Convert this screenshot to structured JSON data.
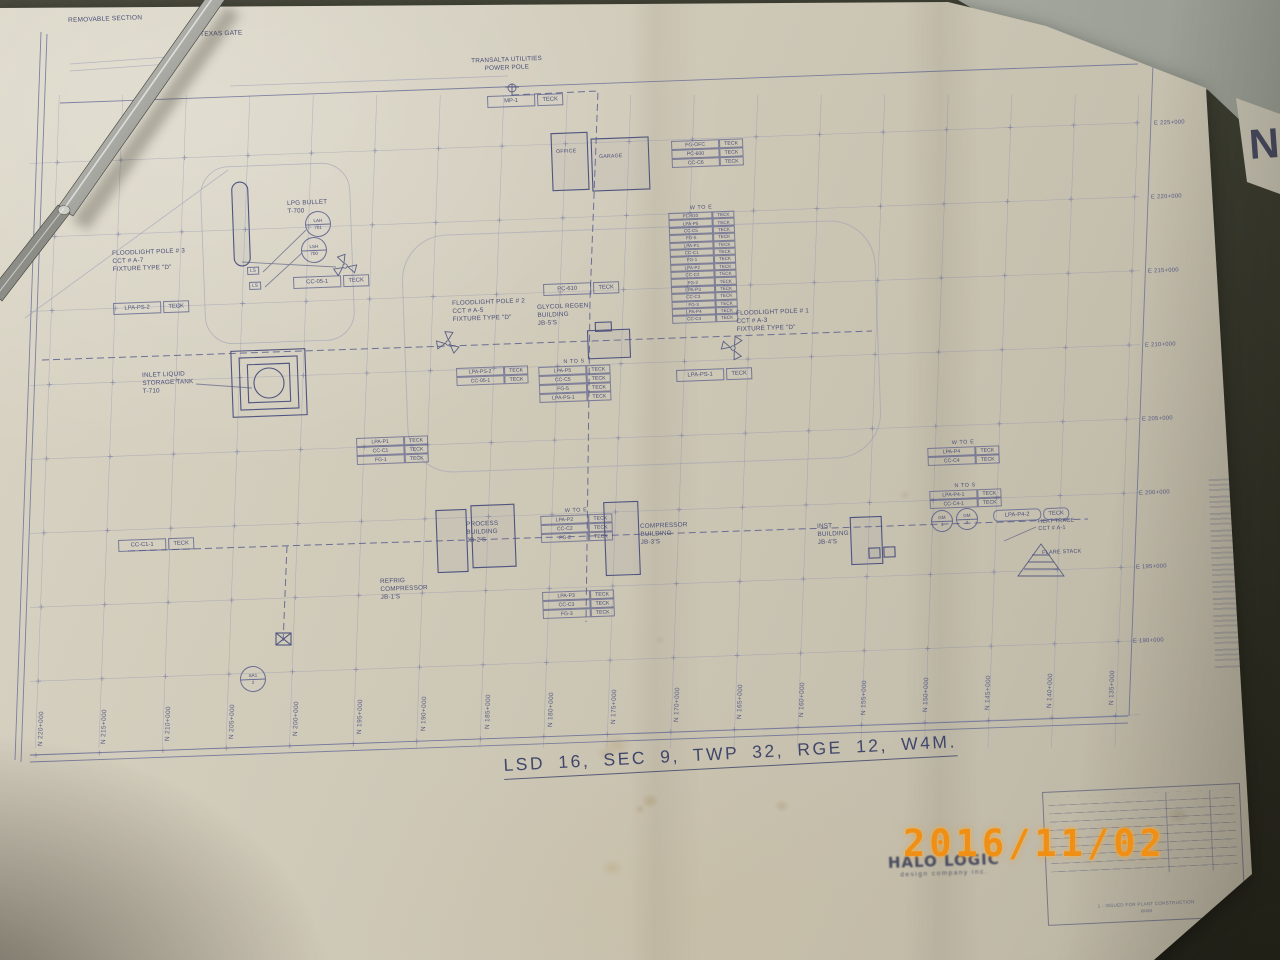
{
  "camera": {
    "timestamp": "2016/11/02"
  },
  "drawing": {
    "legal_description": "LSD 16, SEC 9, TWP 32, RGE 12, W4M.",
    "corner_letter": "N",
    "cable_type": "TECK",
    "logo": {
      "name": "HALO LOGIC",
      "tagline": "design company inc."
    },
    "title_block": {
      "revision_note_1": "1 - ISSUED FOR PLANT CONSTRUCTION",
      "revision_note_2": "W4M"
    },
    "labels": [
      {
        "x": 68,
        "y": 17,
        "size": 6.5,
        "lines": [
          "REMOVABLE SECTION"
        ]
      },
      {
        "x": 200,
        "y": 31,
        "size": 6.5,
        "lines": [
          "TEXAS GATE"
        ]
      },
      {
        "x": 459,
        "y": 58,
        "center": true,
        "w": 95,
        "lines": [
          "TRANSALTA UTILITIES",
          "POWER POLE"
        ]
      },
      {
        "x": 287,
        "y": 200,
        "lines": [
          "LPG BULLET",
          "T-700"
        ]
      },
      {
        "x": 112,
        "y": 250,
        "lines": [
          "FLOODLIGHT POLE # 3",
          "CCT # A-7",
          "FIXTURE TYPE \"D\""
        ]
      },
      {
        "x": 452,
        "y": 300,
        "lines": [
          "FLOODLIGHT POLE # 2",
          "CCT # A-5",
          "FIXTURE TYPE \"D\""
        ]
      },
      {
        "x": 537,
        "y": 304,
        "lines": [
          "GLYCOL REGEN",
          "BUILDING",
          "JB-5'S"
        ]
      },
      {
        "x": 736,
        "y": 310,
        "lines": [
          "FLOODLIGHT POLE # 1",
          "CCT # A-3",
          "FIXTURE TYPE \"D\""
        ]
      },
      {
        "x": 142,
        "y": 372,
        "lines": [
          "INLET LIQUID",
          "STORAGE TANK",
          "T-710"
        ]
      },
      {
        "x": 466,
        "y": 521,
        "lines": [
          "PROCESS",
          "BUILDING",
          "JB-2'S"
        ]
      },
      {
        "x": 640,
        "y": 523,
        "lines": [
          "COMPRESSOR",
          "BUILDING",
          "JB-3'S"
        ]
      },
      {
        "x": 817,
        "y": 523,
        "lines": [
          "INST",
          "BUILDING",
          "JB-4'S"
        ]
      },
      {
        "x": 380,
        "y": 578,
        "lines": [
          "REFRIG",
          "COMPRESSOR",
          "JB-1'S"
        ]
      },
      {
        "x": 1038,
        "y": 519,
        "size": 5.5,
        "lines": [
          "HEAT TRACE",
          "CCT # A-1"
        ]
      },
      {
        "x": 1042,
        "y": 550,
        "size": 5.5,
        "lines": [
          "FLARE STACK"
        ]
      },
      {
        "x": 556,
        "y": 149,
        "size": 5.2,
        "lines": [
          "OFFICE"
        ]
      },
      {
        "x": 599,
        "y": 154,
        "size": 5.2,
        "lines": [
          "GARAGE"
        ]
      },
      {
        "x": 247,
        "y": 267,
        "size": 4.6,
        "boxed": true,
        "lines": [
          "LS"
        ]
      },
      {
        "x": 249,
        "y": 282,
        "size": 4.6,
        "boxed": true,
        "lines": [
          "LS"
        ]
      }
    ],
    "tags": [
      {
        "x": 487,
        "y": 96,
        "label": "MP-1"
      },
      {
        "x": 293,
        "y": 277,
        "label": "CC-05-1"
      },
      {
        "x": 113,
        "y": 303,
        "label": "LPA-PS-2"
      },
      {
        "x": 543,
        "y": 284,
        "label": "PC-610"
      },
      {
        "x": 676,
        "y": 370,
        "label": "LPA-PS-1"
      },
      {
        "x": 118,
        "y": 540,
        "label": "CC-C1-1"
      },
      {
        "x": 993,
        "y": 510,
        "label": "LPA-P4-2",
        "rounded": true
      }
    ],
    "tables": [
      {
        "x": 668,
        "y": 206,
        "header": "W TO E",
        "small": true,
        "rows": [
          "PC-610",
          "LPA-P5",
          "CC-C5",
          "FG-5",
          "LPA-P1",
          "CC-C1",
          "FG-1",
          "LPA-P2",
          "CC-C2",
          "FG-2",
          "LPA-P3",
          "CC-C3",
          "FG-3",
          "LPA-P4",
          "CC-C4"
        ]
      },
      {
        "x": 671,
        "y": 141,
        "rows": [
          "FG-OFC",
          "PC-600",
          "CC-C6"
        ]
      },
      {
        "x": 538,
        "y": 360,
        "header": "N TO S",
        "rows": [
          "LPA-P5",
          "CC-C5",
          "FG-5",
          "LPA-PS-1"
        ]
      },
      {
        "x": 456,
        "y": 368,
        "rows": [
          "LPA-PS-2",
          "CC-05-1"
        ]
      },
      {
        "x": 356,
        "y": 438,
        "rows": [
          "LPA-P1",
          "CC-C1",
          "FG-1"
        ]
      },
      {
        "x": 540,
        "y": 509,
        "header": "W TO E",
        "rows": [
          "LPA-P2",
          "CC-C2",
          "FG-2"
        ]
      },
      {
        "x": 542,
        "y": 592,
        "rows": [
          "LPA-P3",
          "CC-C3",
          "FG-3"
        ]
      },
      {
        "x": 927,
        "y": 441,
        "header": "W TO E",
        "rows": [
          "LPA-P4",
          "CC-C4"
        ]
      },
      {
        "x": 929,
        "y": 484,
        "header": "N TO S",
        "rows": [
          "LPA-P4-1",
          "CC-C4-1"
        ]
      }
    ],
    "bubbles": [
      {
        "x": 317,
        "y": 223,
        "r": 12,
        "top": "LAH",
        "bottom": "701"
      },
      {
        "x": 313,
        "y": 249,
        "r": 12,
        "top": "LSH",
        "bottom": "700"
      },
      {
        "x": 941,
        "y": 520,
        "r": 10,
        "top": "GM",
        "bottom": "1"
      },
      {
        "x": 966,
        "y": 518,
        "r": 10,
        "top": "GM",
        "bottom": "2"
      },
      {
        "x": 252,
        "y": 678,
        "r": 12,
        "top": "SA1",
        "bottom": "2"
      }
    ],
    "stations_bottom": [
      {
        "x": 37,
        "label": "N 220+000"
      },
      {
        "x": 100,
        "label": "N 215+000"
      },
      {
        "x": 164,
        "label": "N 210+000"
      },
      {
        "x": 228,
        "label": "N 205+000"
      },
      {
        "x": 292,
        "label": "N 200+000"
      },
      {
        "x": 356,
        "label": "N 195+000"
      },
      {
        "x": 420,
        "label": "N 190+000"
      },
      {
        "x": 484,
        "label": "N 185+000"
      },
      {
        "x": 547,
        "label": "N 180+000"
      },
      {
        "x": 610,
        "label": "N 175+000"
      },
      {
        "x": 673,
        "label": "N 170+000"
      },
      {
        "x": 736,
        "label": "N 165+000"
      },
      {
        "x": 798,
        "label": "N 160+000"
      },
      {
        "x": 860,
        "label": "N 155+000"
      },
      {
        "x": 922,
        "label": "N 150+000"
      },
      {
        "x": 984,
        "label": "N 145+000"
      },
      {
        "x": 1046,
        "label": "N 140+000"
      },
      {
        "x": 1108,
        "label": "N 135+000"
      }
    ],
    "stations_right": [
      {
        "x": 1154,
        "y": 120,
        "label": "E 225+000"
      },
      {
        "x": 1151,
        "y": 194,
        "label": "E 220+000"
      },
      {
        "x": 1148,
        "y": 268,
        "label": "E 215+000"
      },
      {
        "x": 1145,
        "y": 342,
        "label": "E 210+000"
      },
      {
        "x": 1142,
        "y": 416,
        "label": "E 205+000"
      },
      {
        "x": 1139,
        "y": 490,
        "label": "E 200+000"
      },
      {
        "x": 1136,
        "y": 564,
        "label": "E 195+000"
      },
      {
        "x": 1133,
        "y": 638,
        "label": "E 190+000"
      }
    ]
  }
}
